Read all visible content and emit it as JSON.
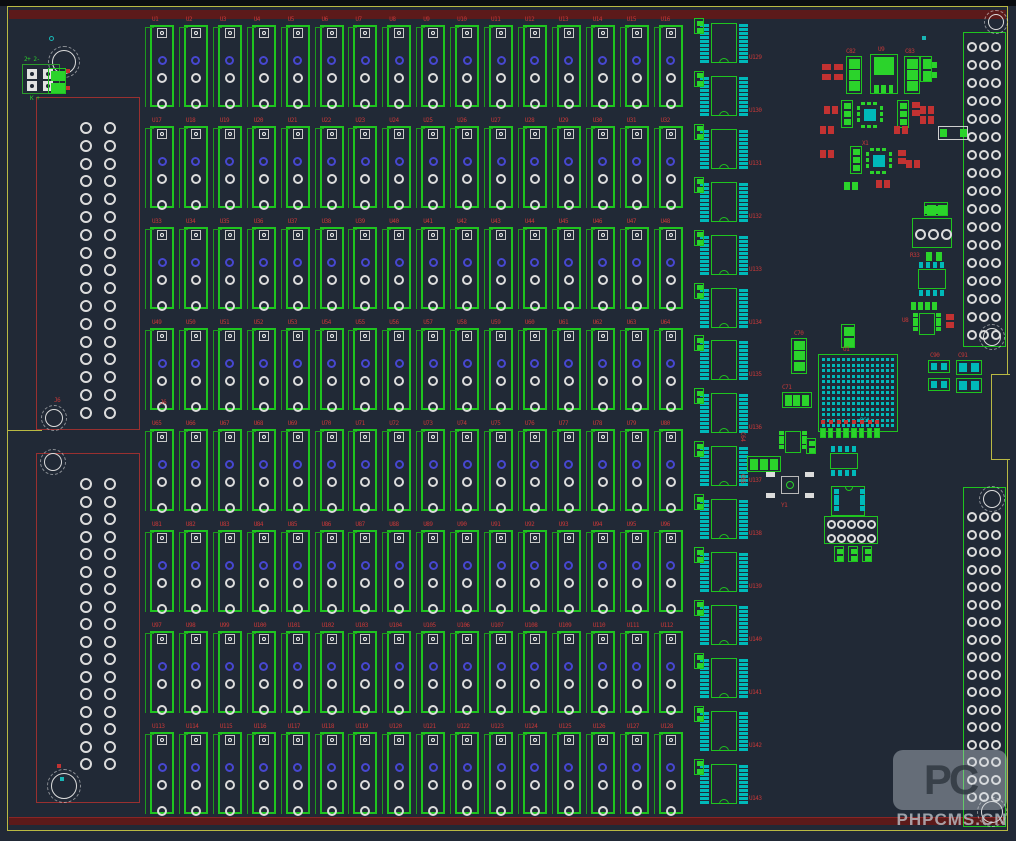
{
  "canvas": {
    "kind": "pcb-layout-editor-view",
    "width": 1016,
    "height": 841
  },
  "colors": {
    "background": "#212936",
    "top_strip": "#0b0d11",
    "board_outline_yellow": "#b9b943",
    "keepout_maroon": "#5c1a1a",
    "keepout_edge": "#8a2525",
    "silk_green": "#1fc41f",
    "fill_green": "#2bd32b",
    "pad_cyan": "#00b9b9",
    "part_red": "#c23232",
    "label_red": "#c63838",
    "pad_white": "#dcdcdc",
    "pad_blue": "#4747d0",
    "connector_red_outline": "#993030",
    "via_teal": "#19b5b5"
  },
  "board_outline": {
    "rect": {
      "x": 7,
      "y": 6,
      "w": 1001,
      "h": 825
    },
    "right_notch": {
      "x": 991,
      "y": 374,
      "w": 19,
      "h": 86
    },
    "left_slot_y": 430,
    "top_bar": {
      "x": 9,
      "y": 10,
      "w": 997,
      "h": 9
    },
    "bottom_bar": {
      "x": 9,
      "y": 817,
      "w": 997,
      "h": 8
    }
  },
  "relay_grid": {
    "rows": 8,
    "cols": 16,
    "x0": 150,
    "y0": 25,
    "dx": 33.9,
    "dy": 101,
    "w": 24,
    "h": 82,
    "designator_prefix": "U",
    "designator_start": 1
  },
  "ic_column": {
    "count": 15,
    "x": 711,
    "y0": 23,
    "dy": 52.9,
    "body_w": 26,
    "body_h": 40,
    "pins_per_side": 10,
    "designator_prefix": "U",
    "designator_start": 129
  },
  "left_connectors": [
    {
      "label": "J6",
      "x": 36,
      "y": 97,
      "w": 104,
      "h": 333,
      "pad_cols": [
        80,
        104
      ],
      "pad_row0": 122,
      "pad_dy": 17.8,
      "pad_rows": 17
    },
    {
      "label": "",
      "x": 36,
      "y": 453,
      "w": 104,
      "h": 350,
      "pad_cols": [
        80,
        104
      ],
      "pad_row0": 478,
      "pad_dy": 17.5,
      "pad_rows": 17
    }
  ],
  "right_connectors": [
    {
      "x": 963,
      "y": 32,
      "w": 43,
      "h": 315,
      "pad_cols": [
        967,
        979,
        991
      ],
      "pad_row0": 42,
      "pad_dy": 18,
      "pad_rows": 17
    },
    {
      "x": 963,
      "y": 487,
      "w": 43,
      "h": 340,
      "pad_cols": [
        967,
        979,
        991
      ],
      "pad_row0": 512,
      "pad_dy": 17.5,
      "pad_rows": 17
    }
  ],
  "mounting_holes": [
    {
      "x": 64,
      "y": 62,
      "r": 12
    },
    {
      "x": 54,
      "y": 418,
      "r": 9
    },
    {
      "x": 53,
      "y": 462,
      "r": 9
    },
    {
      "x": 64,
      "y": 786,
      "r": 13
    },
    {
      "x": 996,
      "y": 22,
      "r": 8
    },
    {
      "x": 992,
      "y": 337,
      "r": 9
    },
    {
      "x": 992,
      "y": 499,
      "r": 9
    },
    {
      "x": 992,
      "y": 812,
      "r": 11
    }
  ],
  "misc_components": [
    {
      "type": "sq2w",
      "x": 22,
      "y": 64,
      "w": 38,
      "h": 30,
      "t1": "2+ 2-",
      "t2": "K +"
    },
    {
      "type": "psq2",
      "x": 48,
      "y": 68,
      "w": 18,
      "h": 26,
      "dir": "v"
    },
    {
      "type": "reddot",
      "x": 66,
      "y": 69
    },
    {
      "type": "reddot",
      "x": 66,
      "y": 86
    },
    {
      "type": "tealdot",
      "x": 49,
      "y": 36
    },
    {
      "type": "rlabel",
      "x": 54,
      "y": 398,
      "text": "J6"
    },
    {
      "type": "reddot",
      "x": 57,
      "y": 764
    },
    {
      "type": "tealsq",
      "x": 60,
      "y": 777
    },
    {
      "type": "p2",
      "x": 822,
      "y": 64,
      "w": 9,
      "h": 16,
      "c": "red",
      "dir": "v"
    },
    {
      "type": "p2",
      "x": 834,
      "y": 64,
      "w": 9,
      "h": 16,
      "c": "red",
      "dir": "v"
    },
    {
      "type": "cap3",
      "x": 846,
      "y": 56,
      "w": 16,
      "h": 38,
      "dir": "v"
    },
    {
      "type": "reg",
      "x": 870,
      "y": 54,
      "w": 28,
      "h": 40
    },
    {
      "type": "cap3",
      "x": 904,
      "y": 56,
      "w": 16,
      "h": 38,
      "dir": "v"
    },
    {
      "type": "p2",
      "x": 928,
      "y": 62,
      "w": 9,
      "h": 16,
      "c": "grn",
      "dir": "v"
    },
    {
      "type": "rlabel",
      "x": 846,
      "y": 49,
      "text": "C82"
    },
    {
      "type": "rlabel",
      "x": 878,
      "y": 47,
      "text": "U9"
    },
    {
      "type": "rlabel",
      "x": 905,
      "y": 49,
      "text": "C83"
    },
    {
      "type": "p2",
      "x": 824,
      "y": 106,
      "w": 14,
      "h": 8,
      "c": "red",
      "dir": "h"
    },
    {
      "type": "cap3",
      "x": 841,
      "y": 100,
      "w": 12,
      "h": 28,
      "dir": "v"
    },
    {
      "type": "qfp",
      "x": 857,
      "y": 102,
      "w": 26,
      "h": 26
    },
    {
      "type": "cap3",
      "x": 897,
      "y": 100,
      "w": 12,
      "h": 28,
      "dir": "v"
    },
    {
      "type": "p2",
      "x": 912,
      "y": 102,
      "w": 8,
      "h": 14,
      "c": "red",
      "dir": "v"
    },
    {
      "type": "p2",
      "x": 820,
      "y": 126,
      "w": 14,
      "h": 8,
      "c": "red",
      "dir": "h"
    },
    {
      "type": "p2",
      "x": 894,
      "y": 126,
      "w": 14,
      "h": 8,
      "c": "red",
      "dir": "h"
    },
    {
      "type": "p2",
      "x": 820,
      "y": 150,
      "w": 14,
      "h": 8,
      "c": "red",
      "dir": "h"
    },
    {
      "type": "cap3",
      "x": 850,
      "y": 146,
      "w": 12,
      "h": 28,
      "dir": "v"
    },
    {
      "type": "qfp",
      "x": 866,
      "y": 148,
      "w": 26,
      "h": 26
    },
    {
      "type": "p2",
      "x": 898,
      "y": 150,
      "w": 8,
      "h": 14,
      "c": "red",
      "dir": "v"
    },
    {
      "type": "p2",
      "x": 906,
      "y": 160,
      "w": 14,
      "h": 8,
      "c": "red",
      "dir": "h"
    },
    {
      "type": "p2",
      "x": 876,
      "y": 180,
      "w": 14,
      "h": 8,
      "c": "red",
      "dir": "h"
    },
    {
      "type": "p2",
      "x": 844,
      "y": 182,
      "w": 14,
      "h": 8,
      "c": "grn",
      "dir": "h"
    },
    {
      "type": "rlabel",
      "x": 862,
      "y": 141,
      "text": "X1"
    },
    {
      "type": "tealsq",
      "x": 922,
      "y": 36
    },
    {
      "type": "psq2",
      "x": 920,
      "y": 56,
      "w": 12,
      "h": 26,
      "dir": "v"
    },
    {
      "type": "p2",
      "x": 920,
      "y": 106,
      "w": 14,
      "h": 8,
      "c": "red",
      "dir": "h"
    },
    {
      "type": "p2",
      "x": 920,
      "y": 116,
      "w": 14,
      "h": 8,
      "c": "red",
      "dir": "h"
    },
    {
      "type": "wrect",
      "x": 938,
      "y": 126,
      "w": 30,
      "h": 14
    },
    {
      "type": "psq2",
      "x": 924,
      "y": 202,
      "w": 24,
      "h": 14,
      "dir": "h"
    },
    {
      "type": "term3",
      "x": 912,
      "y": 218,
      "w": 40,
      "h": 30
    },
    {
      "type": "p2",
      "x": 926,
      "y": 252,
      "w": 16,
      "h": 9,
      "c": "grn",
      "dir": "h"
    },
    {
      "type": "rlabel",
      "x": 910,
      "y": 253,
      "text": "R33"
    },
    {
      "type": "soic8c",
      "x": 914,
      "y": 262,
      "w": 36,
      "h": 34
    },
    {
      "type": "p2",
      "x": 911,
      "y": 302,
      "w": 12,
      "h": 8,
      "c": "grn",
      "dir": "h"
    },
    {
      "type": "p2",
      "x": 925,
      "y": 302,
      "w": 12,
      "h": 8,
      "c": "grn",
      "dir": "h"
    },
    {
      "type": "soic8g",
      "x": 913,
      "y": 312,
      "w": 28,
      "h": 24
    },
    {
      "type": "p2",
      "x": 946,
      "y": 314,
      "w": 8,
      "h": 14,
      "c": "red",
      "dir": "v"
    },
    {
      "type": "rlabel",
      "x": 902,
      "y": 318,
      "text": "U8"
    },
    {
      "type": "psq2",
      "x": 841,
      "y": 324,
      "w": 14,
      "h": 24,
      "dir": "v"
    },
    {
      "type": "cap3",
      "x": 791,
      "y": 338,
      "w": 16,
      "h": 36,
      "dir": "v"
    },
    {
      "type": "rlabel",
      "x": 794,
      "y": 331,
      "text": "C70"
    },
    {
      "type": "bga",
      "x": 818,
      "y": 354,
      "w": 80,
      "h": 78,
      "cols": 15,
      "rows": 13
    },
    {
      "type": "rlabel",
      "x": 843,
      "y": 347,
      "text": "U1"
    },
    {
      "type": "clabel",
      "x": 860,
      "y": 418,
      "text": "BGA"
    },
    {
      "type": "cap3",
      "x": 782,
      "y": 392,
      "w": 30,
      "h": 16,
      "dir": "h"
    },
    {
      "type": "rlabel",
      "x": 782,
      "y": 385,
      "text": "C71"
    },
    {
      "type": "hdr8",
      "x": 820,
      "y": 420,
      "w": 62,
      "h": 20
    },
    {
      "type": "soic8g",
      "x": 779,
      "y": 430,
      "w": 28,
      "h": 24
    },
    {
      "type": "psq2",
      "x": 806,
      "y": 438,
      "w": 10,
      "h": 16,
      "dir": "v"
    },
    {
      "type": "cap3",
      "x": 747,
      "y": 456,
      "w": 34,
      "h": 16,
      "dir": "h"
    },
    {
      "type": "rlabel",
      "x": 745,
      "y": 432,
      "text": "C64",
      "rot": 90
    },
    {
      "type": "rlabel",
      "x": 745,
      "y": 474,
      "text": "C65",
      "rot": 90
    },
    {
      "type": "osc",
      "x": 766,
      "y": 470,
      "w": 48,
      "h": 30
    },
    {
      "type": "rlabel",
      "x": 781,
      "y": 503,
      "text": "Y1"
    },
    {
      "type": "soic8c",
      "x": 826,
      "y": 446,
      "w": 36,
      "h": 30
    },
    {
      "type": "dip8",
      "x": 831,
      "y": 486,
      "w": 34,
      "h": 30
    },
    {
      "type": "hdr2x5",
      "x": 824,
      "y": 516,
      "w": 54,
      "h": 28
    },
    {
      "type": "psq2",
      "x": 834,
      "y": 546,
      "w": 10,
      "h": 16,
      "dir": "v"
    },
    {
      "type": "psq2",
      "x": 848,
      "y": 546,
      "w": 10,
      "h": 16,
      "dir": "v"
    },
    {
      "type": "psq2",
      "x": 862,
      "y": 546,
      "w": 10,
      "h": 16,
      "dir": "v"
    },
    {
      "type": "gc2",
      "x": 928,
      "y": 360,
      "w": 22,
      "h": 13
    },
    {
      "type": "gc2",
      "x": 928,
      "y": 378,
      "w": 22,
      "h": 13
    },
    {
      "type": "gc2",
      "x": 956,
      "y": 360,
      "w": 26,
      "h": 15
    },
    {
      "type": "gc2",
      "x": 956,
      "y": 378,
      "w": 26,
      "h": 15
    },
    {
      "type": "rlabel",
      "x": 930,
      "y": 353,
      "text": "C90"
    },
    {
      "type": "rlabel",
      "x": 958,
      "y": 353,
      "text": "C91"
    }
  ],
  "watermark": {
    "logo": "PC",
    "text": "PHPCMS.CN"
  }
}
